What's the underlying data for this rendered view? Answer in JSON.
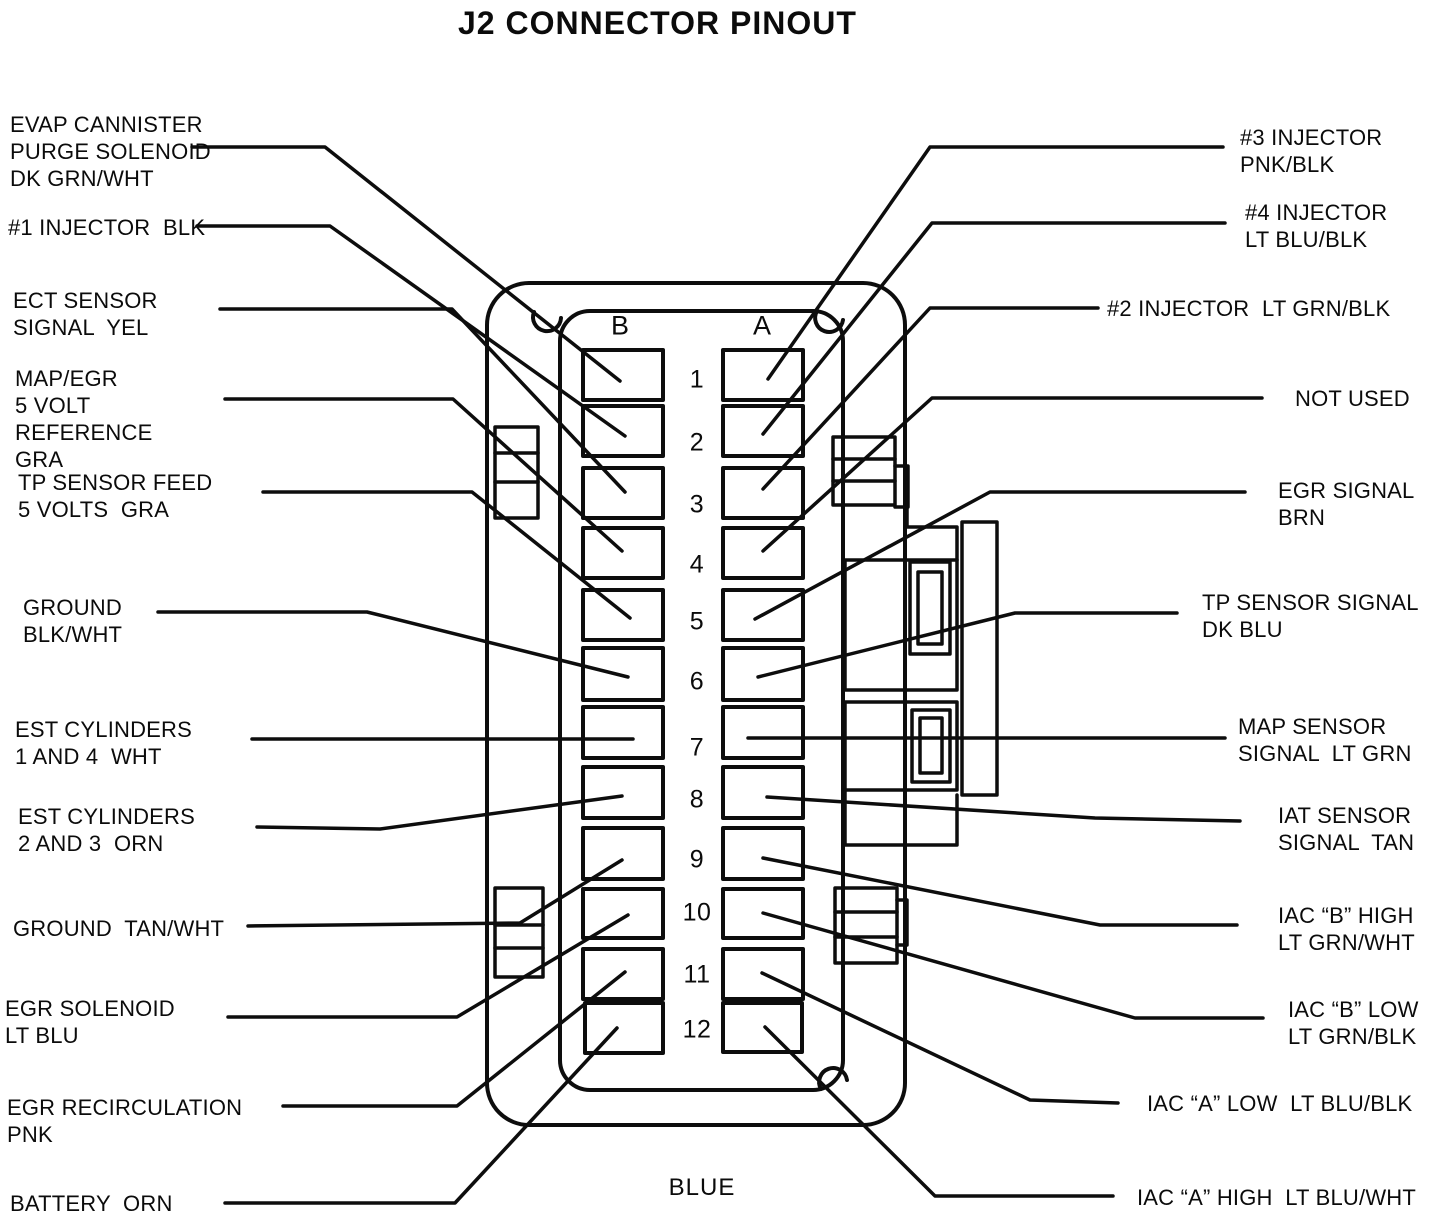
{
  "title": "J2 CONNECTOR PINOUT",
  "connector": {
    "column_b_label": "B",
    "column_a_label": "A",
    "color_label": "BLUE",
    "pin_numbers": [
      "1",
      "2",
      "3",
      "4",
      "5",
      "6",
      "7",
      "8",
      "9",
      "10",
      "11",
      "12"
    ]
  },
  "left_labels": [
    {
      "pin": "B1",
      "lines": [
        "EVAP CANNISTER",
        "PURGE SOLENOID",
        "DK GRN/WHT"
      ]
    },
    {
      "pin": "B2",
      "lines": [
        "#1 INJECTOR  BLK"
      ]
    },
    {
      "pin": "B3",
      "lines": [
        "ECT SENSOR",
        "SIGNAL  YEL"
      ]
    },
    {
      "pin": "B4",
      "lines": [
        "MAP/EGR",
        "5 VOLT",
        "REFERENCE",
        "GRA"
      ]
    },
    {
      "pin": "B5",
      "lines": [
        "TP SENSOR FEED",
        "5 VOLTS  GRA"
      ]
    },
    {
      "pin": "B6",
      "lines": [
        "GROUND",
        "BLK/WHT"
      ]
    },
    {
      "pin": "B7",
      "lines": [
        "EST CYLINDERS",
        "1 AND 4  WHT"
      ]
    },
    {
      "pin": "B8",
      "lines": [
        "EST CYLINDERS",
        "2 AND 3  ORN"
      ]
    },
    {
      "pin": "B9",
      "lines": [
        "GROUND  TAN/WHT"
      ]
    },
    {
      "pin": "B10",
      "lines": [
        "EGR SOLENOID",
        "LT BLU"
      ]
    },
    {
      "pin": "B11",
      "lines": [
        "EGR RECIRCULATION",
        "PNK"
      ]
    },
    {
      "pin": "B12",
      "lines": [
        "BATTERY  ORN"
      ]
    }
  ],
  "right_labels": [
    {
      "pin": "A1",
      "lines": [
        "#3 INJECTOR",
        "PNK/BLK"
      ]
    },
    {
      "pin": "A2",
      "lines": [
        "#4 INJECTOR",
        "LT BLU/BLK"
      ]
    },
    {
      "pin": "A3",
      "lines": [
        "#2 INJECTOR  LT GRN/BLK"
      ]
    },
    {
      "pin": "A4",
      "lines": [
        "NOT USED"
      ]
    },
    {
      "pin": "A5",
      "lines": [
        "EGR SIGNAL",
        "BRN"
      ]
    },
    {
      "pin": "A6",
      "lines": [
        "TP SENSOR SIGNAL",
        "DK BLU"
      ]
    },
    {
      "pin": "A7",
      "lines": [
        "MAP SENSOR",
        "SIGNAL  LT GRN"
      ]
    },
    {
      "pin": "A8",
      "lines": [
        "IAT SENSOR",
        "SIGNAL  TAN"
      ]
    },
    {
      "pin": "A9",
      "lines": [
        "IAC “B” HIGH",
        "LT GRN/WHT"
      ]
    },
    {
      "pin": "A10",
      "lines": [
        "IAC “B” LOW",
        "LT GRN/BLK"
      ]
    },
    {
      "pin": "A11",
      "lines": [
        "IAC “A” LOW  LT BLU/BLK"
      ]
    },
    {
      "pin": "A12",
      "lines": [
        "IAC “A” HIGH  LT BLU/WHT"
      ]
    }
  ],
  "colors": {
    "ink": "#0d0d0d",
    "paper": "#ffffff"
  }
}
